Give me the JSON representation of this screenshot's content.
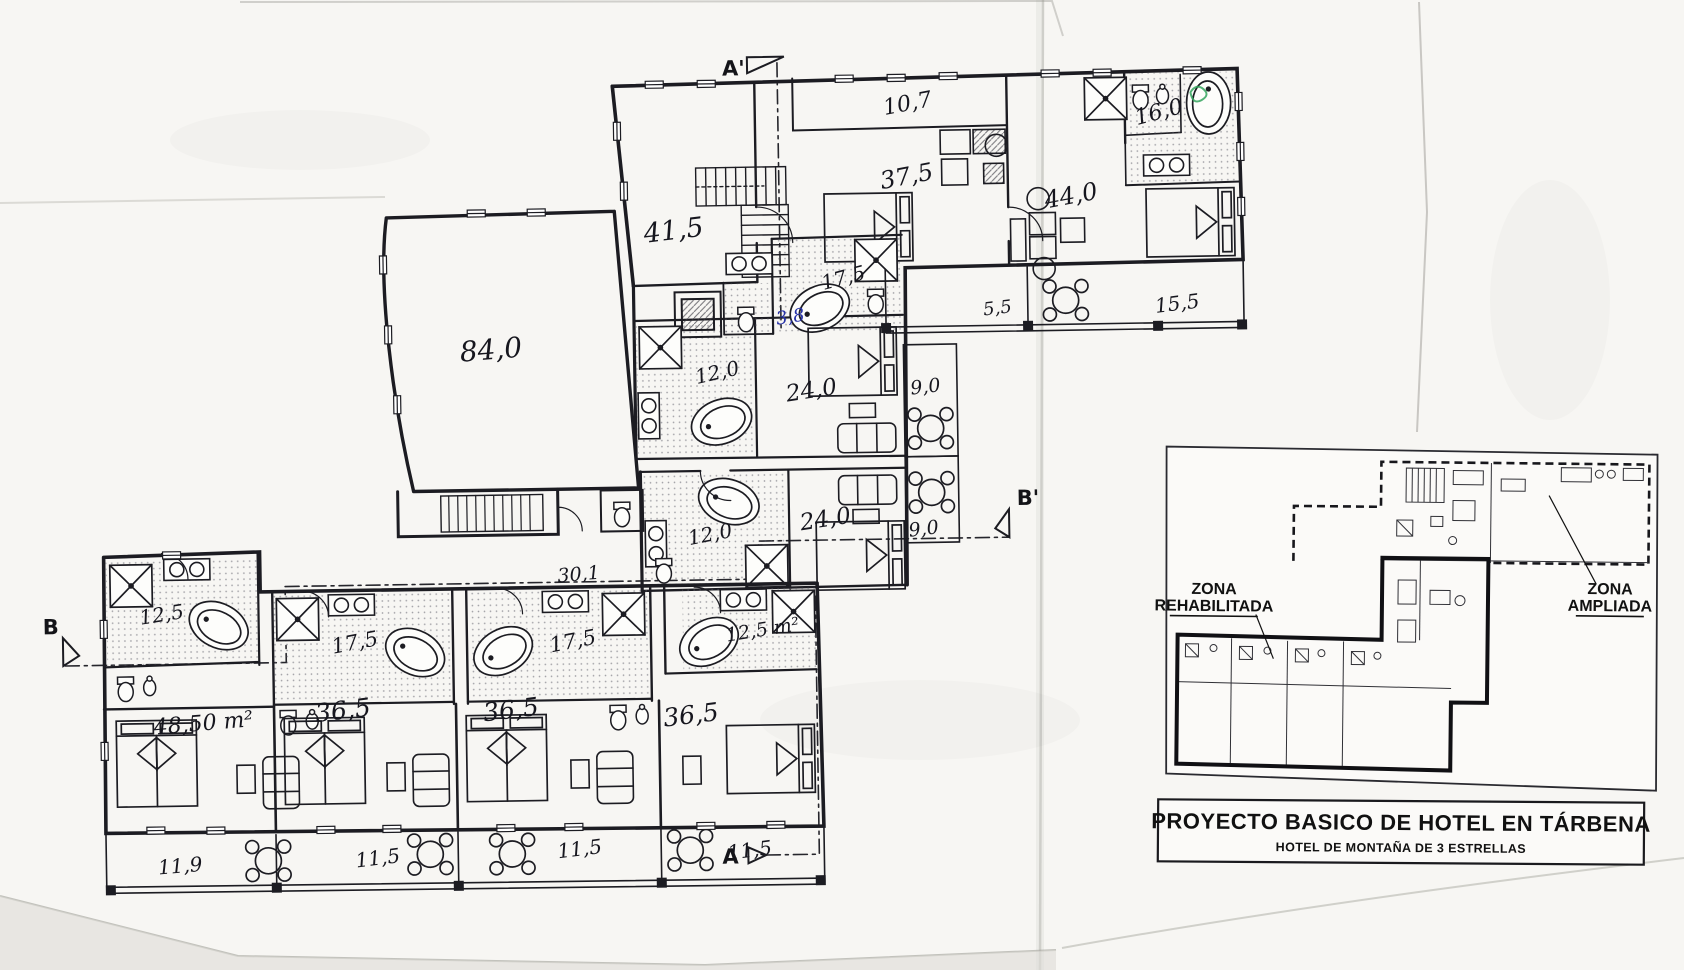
{
  "drawing": {
    "kind": "scanned hand-drafted hotel floor plan",
    "ink_color": "#1c1c22",
    "blue_ink_color": "#2732a8",
    "green_mark_color": "#35a45e",
    "paper_color": "#f7f6f3"
  },
  "areas": {
    "a41_5": "41,5",
    "a10_7": "10,7",
    "a37_5": "37,5",
    "a44_0": "44,0",
    "a16_0": "16,0",
    "a17_5u": "17,5",
    "a3_8": "3,8",
    "a5_5": "5,5",
    "a15_5": "15,5",
    "a84_0": "84,0",
    "a12_0u": "12,0",
    "a24_0u": "24,0",
    "a9_0u": "9,0",
    "a12_0l": "12,0",
    "a24_0l": "24,0",
    "a9_0l": "9,0",
    "a30_1": "30,1",
    "a12_5b1": "12,5",
    "a17_5b2": "17,5",
    "a17_5b3": "17,5",
    "a12_5b4": "12,5 m²",
    "a48_50": "48,50 m²",
    "a36_5r1": "36,5",
    "a36_5r2": "36,5",
    "a36_5r3": "36,5",
    "t11_9": "11,9",
    "t11_5a": "11,5",
    "t11_5b": "11,5",
    "t11_5c": "11,5"
  },
  "sections": {
    "a_prime": "A'",
    "a": "A",
    "b": "B",
    "b_prime": "B'"
  },
  "inset": {
    "rehabilitada_line1": "ZONA",
    "rehabilitada_line2": "REHABILITADA",
    "ampliada_line1": "ZONA",
    "ampliada_line2": "AMPLIADA"
  },
  "title_block": {
    "line1": "PROYECTO BASICO DE HOTEL EN TÁRBENA",
    "line2": "HOTEL DE MONTAÑA DE 3 ESTRELLAS"
  }
}
